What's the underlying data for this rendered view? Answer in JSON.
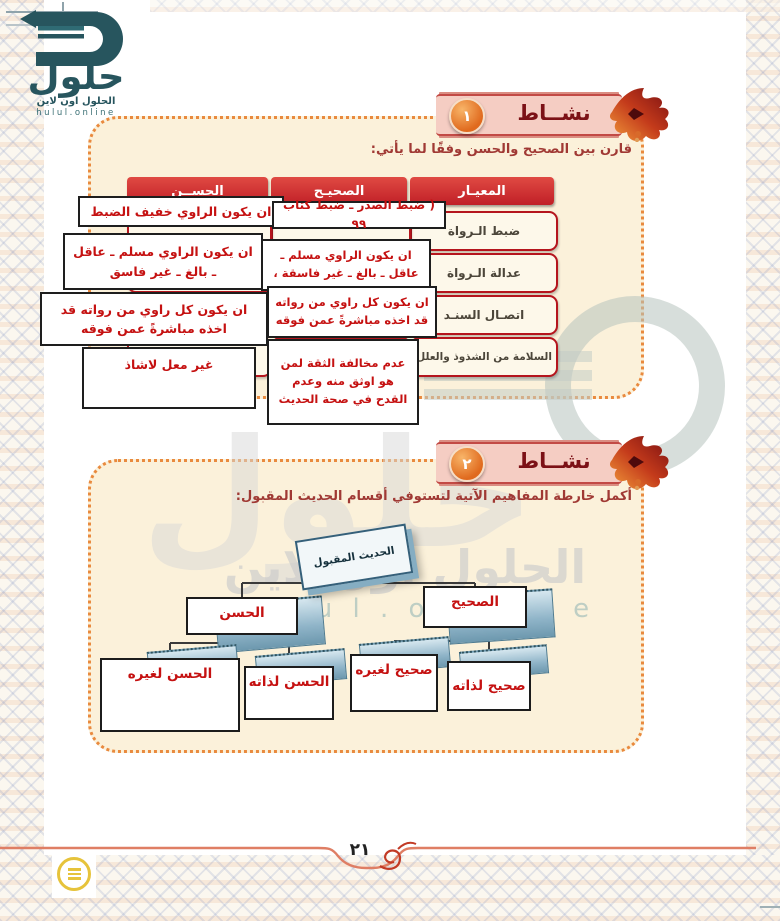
{
  "page": {
    "number": "٢١"
  },
  "logo": {
    "brand": "حلول",
    "line1": "الحلول اون لاين",
    "line2": "hulul.online"
  },
  "watermark": {
    "big": "حلول",
    "mid": "الحلول اون لاين",
    "eng": "h u l u l . o n l i n e"
  },
  "activity1": {
    "badge": {
      "label": "نشــاط",
      "number": "١"
    },
    "instruction": "قارن بين الصحيح والحسن وفقًا لما يأتي:",
    "headers": {
      "criterion": "المعيـار",
      "sahih": "الصحيـح",
      "hasan": "الحســن"
    },
    "criteria": [
      "ضبط الـرواة",
      "عدالة الـرواة",
      "اتصـال السنـد",
      "السلامة من الشذوذ والعلل"
    ],
    "answers": {
      "sahih_dabt": "( ضبط الصدر ـ ضبط كتاب ٩٩",
      "hasan_dabt": "ان يكون الراوي خفيف الضبط",
      "sahih_adalah": "ان يكون الراوي مسلم ـ عاقل ـ بالغ ـ غير فاسقة ،",
      "hasan_adalah": "ان يكون الراوي مسلم ـ عاقل ـ بالغ ـ غير فاسق",
      "sahih_ittisal": "ان يكون كل راوي من رواته قد اخذه مباشرةً عمن فوقه",
      "hasan_ittisal": "ان يكون كل راوي من رواته قد اخذه مباشرةً عمن فوقه",
      "sahih_salamah": "عدم مخالفة الثقة لمن هو اوثق منه وعدم القدح في صحة الحديث",
      "hasan_salamah": "غير معل لاشاذ"
    }
  },
  "activity2": {
    "badge": {
      "label": "نشــاط",
      "number": "٢"
    },
    "instruction": "أكمل خارطة المفاهيم الآتية لتستوفي أقسام الحديث المقبول:",
    "map": {
      "root": "الحديث المقبول",
      "hasan": "الحسن",
      "sahih": "الصحيح",
      "hasan_lighayrihi": "الحسن لغيره",
      "hasan_lithatihi": "الحسن لذاته",
      "sahih_lighayrihi": "صحيح لغيره",
      "sahih_lithatihi": "صحيح لذاته"
    }
  },
  "colors": {
    "table_header_red": "#cf2b2f",
    "answer_red": "#c51111",
    "panel_cream": "#fbf1da",
    "dots_orange": "#e98a3e",
    "logo_teal": "#27555e",
    "badge_pink": "#f5cdc3"
  }
}
